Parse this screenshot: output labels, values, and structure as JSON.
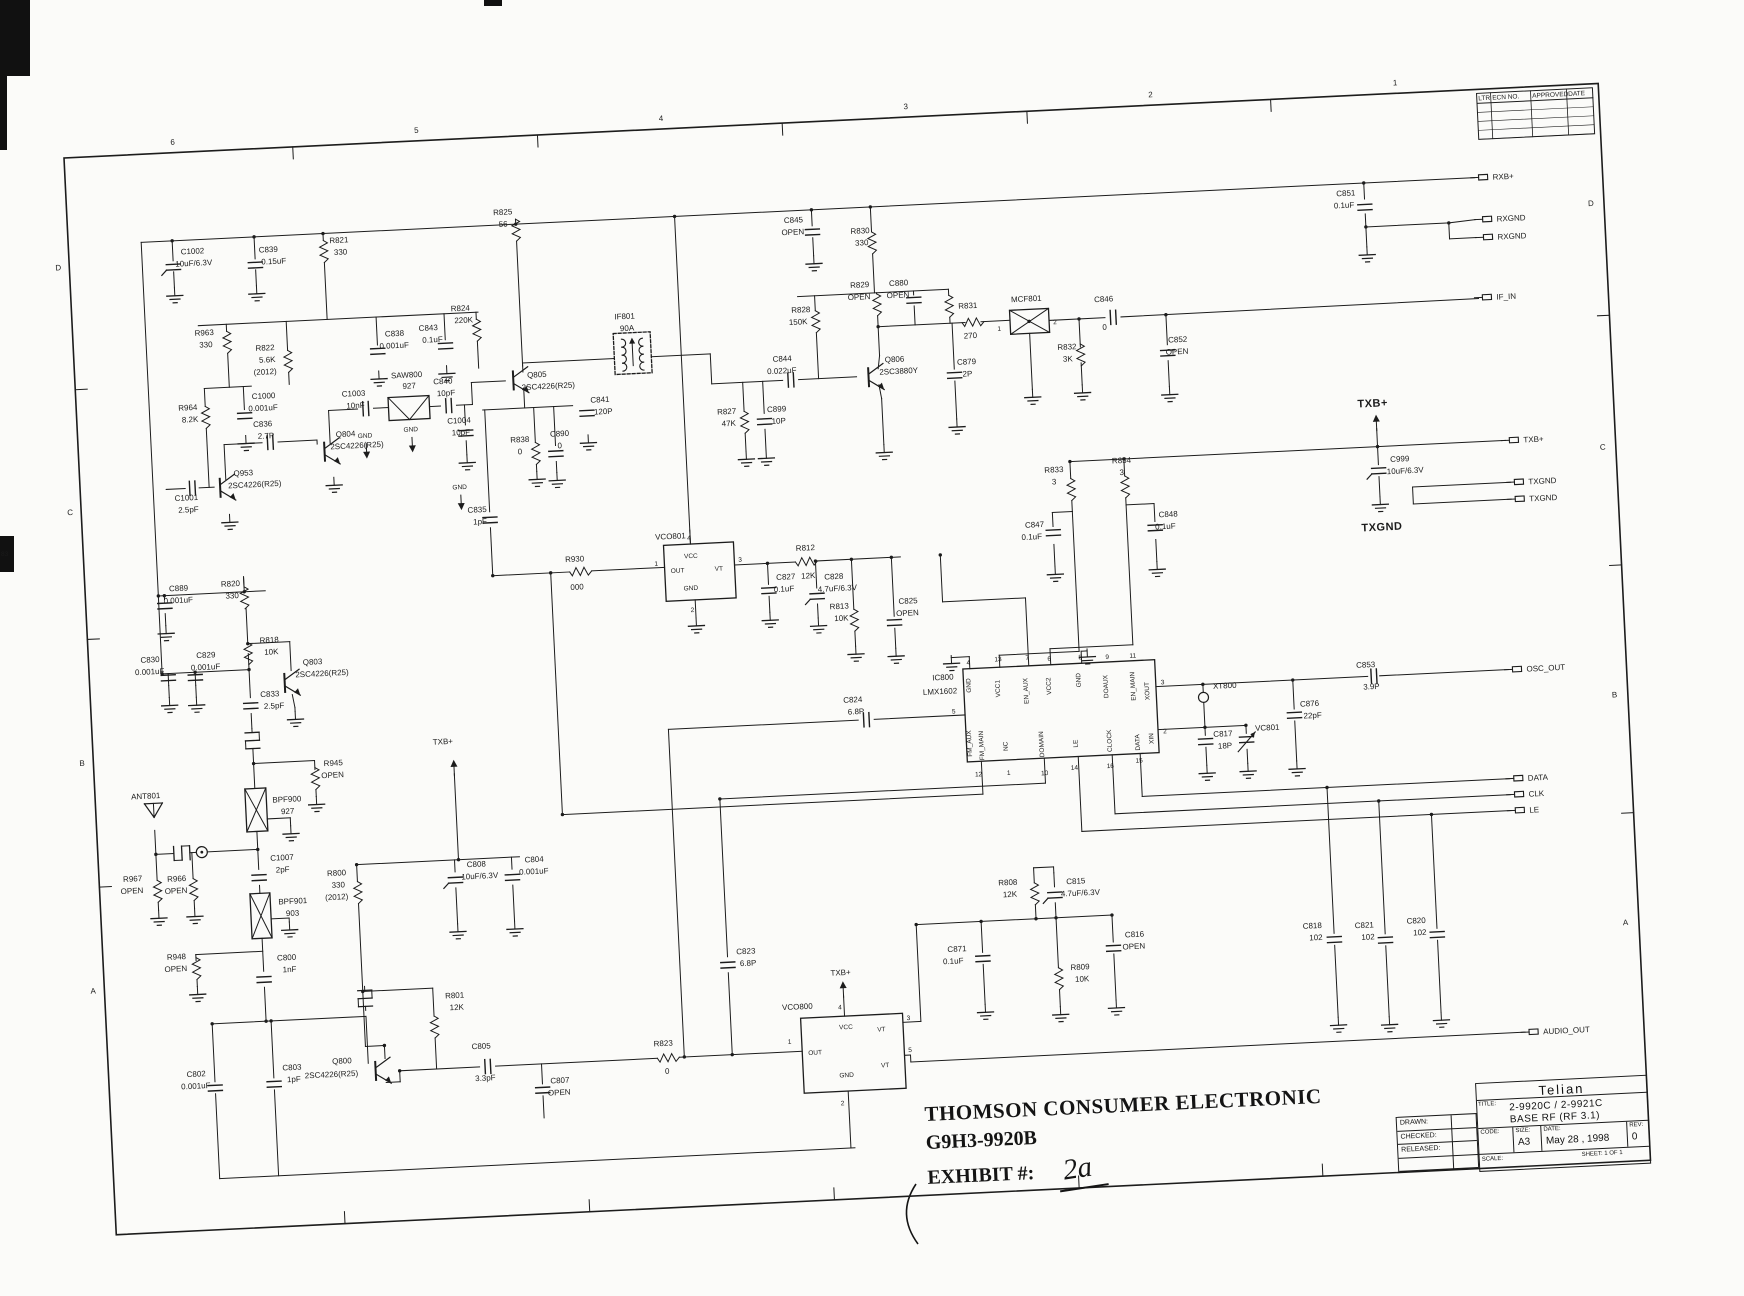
{
  "stamp": {
    "line1": "THOMSON CONSUMER ELECTRONIC",
    "line2": "G9H3-9920B",
    "exhibit_label": "EXHIBIT #:",
    "exhibit_value": "2a"
  },
  "title_block": {
    "company": "Telian",
    "title_label": "TITLE:",
    "title_line1": "2-9920C / 2-9921C",
    "title_line2": "BASE RF (RF 3.1)",
    "drawn_label": "DRAWN:",
    "checked_label": "CHECKED:",
    "released_label": "RELEASED:",
    "code_label": "CODE:",
    "size_label": "SIZE:",
    "size_value": "A3",
    "date_label": "DATE:",
    "date_value": "May 28 , 1998",
    "rev_label": "REV:",
    "rev_value": "0",
    "scale_label": "SCALE:",
    "sheet_label": "SHEET: 1  OF 1"
  },
  "grid": {
    "cols": [
      "6",
      "5",
      "4",
      "3",
      "2",
      "1"
    ],
    "col_x": [
      171,
      415,
      660,
      905,
      1150,
      1395
    ],
    "tick_x": [
      293,
      538,
      783,
      1028,
      1272
    ],
    "rows": [
      "D",
      "C",
      "B",
      "A"
    ],
    "row_y_left": [
      270,
      515,
      766,
      994
    ],
    "row_y_right": [
      280,
      524,
      772,
      1000
    ],
    "side_tick_y": [
      390,
      640,
      888
    ]
  },
  "revision_table": {
    "headers": [
      "LTR",
      "ECN NO.",
      "APPROVED",
      "DATE"
    ],
    "blank_rows": 4
  },
  "scan_marks": {
    "edge_tag": "83"
  },
  "terminals": [
    {
      "label": "RXB+",
      "x": 1476,
      "y": 246
    },
    {
      "label": "RXGND",
      "x": 1478,
      "y": 288
    },
    {
      "label": "RXGND",
      "x": 1478,
      "y": 306
    },
    {
      "label": "IF_IN",
      "x": 1474,
      "y": 366
    },
    {
      "label": "TXB+",
      "x": 1494,
      "y": 510
    },
    {
      "label": "TXGND",
      "x": 1497,
      "y": 552
    },
    {
      "label": "TXGND",
      "x": 1497,
      "y": 569
    },
    {
      "label": "OSC_OUT",
      "x": 1486,
      "y": 739
    },
    {
      "label": "DATA",
      "x": 1482,
      "y": 848
    },
    {
      "label": "CLK",
      "x": 1482,
      "y": 864
    },
    {
      "label": "LE",
      "x": 1482,
      "y": 880
    },
    {
      "label": "AUDIO_OUT",
      "x": 1485,
      "y": 1102
    }
  ],
  "ic_names": [
    {
      "t": "VCO801",
      "x": 636,
      "y": 568
    },
    {
      "t": "VCO800",
      "x": 740,
      "y": 1044
    },
    {
      "t": "IC800",
      "x": 906,
      "y": 722
    },
    {
      "t": "LMX1602",
      "x": 896,
      "y": 736
    },
    {
      "t": "MCF801",
      "x": 1003,
      "y": 348
    },
    {
      "t": "SAW800",
      "x": 380,
      "y": 394
    },
    {
      "t": "927",
      "x": 391,
      "y": 405
    },
    {
      "t": "IF801",
      "x": 606,
      "y": 346
    },
    {
      "t": "90A",
      "x": 611,
      "y": 358
    },
    {
      "t": "BPF900",
      "x": 241,
      "y": 812
    },
    {
      "t": "927",
      "x": 249,
      "y": 824
    },
    {
      "t": "BPF901",
      "x": 242,
      "y": 914
    },
    {
      "t": "903",
      "x": 249,
      "y": 926
    },
    {
      "t": "ANT801",
      "x": 100,
      "y": 802
    },
    {
      "t": "XT800",
      "x": 1186,
      "y": 744
    },
    {
      "t": "VC801",
      "x": 1226,
      "y": 788
    }
  ],
  "labels": [
    {
      "t": "C1002",
      "x": 176,
      "y": 260
    },
    {
      "t": "10uF/6.3V",
      "x": 170,
      "y": 272
    },
    {
      "t": "C839",
      "x": 254,
      "y": 262
    },
    {
      "t": "0.15uF",
      "x": 256,
      "y": 274
    },
    {
      "t": "R821",
      "x": 325,
      "y": 256
    },
    {
      "t": "330",
      "x": 329,
      "y": 268
    },
    {
      "t": "R825",
      "x": 490,
      "y": 236
    },
    {
      "t": "56",
      "x": 495,
      "y": 248
    },
    {
      "t": "R963",
      "x": 186,
      "y": 342
    },
    {
      "t": "330",
      "x": 190,
      "y": 354
    },
    {
      "t": "R822",
      "x": 246,
      "y": 360
    },
    {
      "t": "5.6K",
      "x": 249,
      "y": 372
    },
    {
      "t": "(2012)",
      "x": 243,
      "y": 384
    },
    {
      "t": "R964",
      "x": 166,
      "y": 416
    },
    {
      "t": "8.2K",
      "x": 169,
      "y": 428
    },
    {
      "t": "C1000",
      "x": 240,
      "y": 408
    },
    {
      "t": "0.001uF",
      "x": 236,
      "y": 420
    },
    {
      "t": "C838",
      "x": 376,
      "y": 352
    },
    {
      "t": "0.001uF",
      "x": 370,
      "y": 364
    },
    {
      "t": "C843",
      "x": 410,
      "y": 348
    },
    {
      "t": "0.1uF",
      "x": 413,
      "y": 360
    },
    {
      "t": "R824",
      "x": 443,
      "y": 330
    },
    {
      "t": "220K",
      "x": 446,
      "y": 342
    },
    {
      "t": "C1003",
      "x": 330,
      "y": 410
    },
    {
      "t": "10nF",
      "x": 334,
      "y": 422
    },
    {
      "t": "C840",
      "x": 422,
      "y": 402
    },
    {
      "t": "10pF",
      "x": 425,
      "y": 414
    },
    {
      "t": "C1004",
      "x": 434,
      "y": 442
    },
    {
      "t": "10pF",
      "x": 438,
      "y": 454
    },
    {
      "t": "Q953",
      "x": 218,
      "y": 484
    },
    {
      "t": "2SC4226(R25)",
      "x": 212,
      "y": 496
    },
    {
      "t": "C1001",
      "x": 158,
      "y": 506
    },
    {
      "t": "2.5pF",
      "x": 161,
      "y": 518
    },
    {
      "t": "C836",
      "x": 240,
      "y": 436
    },
    {
      "t": "2.7P",
      "x": 244,
      "y": 448
    },
    {
      "t": "Q804",
      "x": 322,
      "y": 450
    },
    {
      "t": "2SC4226(R25)",
      "x": 316,
      "y": 462
    },
    {
      "t": "GND",
      "x": 344,
      "y": 452,
      "c": "s"
    },
    {
      "t": "GND",
      "x": 390,
      "y": 448,
      "c": "s"
    },
    {
      "t": "GND",
      "x": 436,
      "y": 508,
      "c": "s"
    },
    {
      "t": "Q805",
      "x": 516,
      "y": 400
    },
    {
      "t": "2SC4226(R25)",
      "x": 510,
      "y": 412
    },
    {
      "t": "C841",
      "x": 578,
      "y": 428
    },
    {
      "t": "120P",
      "x": 581,
      "y": 440
    },
    {
      "t": "C835",
      "x": 450,
      "y": 532
    },
    {
      "t": "1pF",
      "x": 455,
      "y": 544
    },
    {
      "t": "R838",
      "x": 496,
      "y": 464
    },
    {
      "t": "0",
      "x": 503,
      "y": 476
    },
    {
      "t": "C890",
      "x": 536,
      "y": 460
    },
    {
      "t": "0",
      "x": 543,
      "y": 472
    },
    {
      "t": "R930",
      "x": 545,
      "y": 586
    },
    {
      "t": "000",
      "x": 549,
      "y": 614
    },
    {
      "t": "R812",
      "x": 776,
      "y": 586
    },
    {
      "t": "12K",
      "x": 780,
      "y": 614
    },
    {
      "t": "C827",
      "x": 755,
      "y": 614
    },
    {
      "t": "0.1uF",
      "x": 752,
      "y": 626
    },
    {
      "t": "C828",
      "x": 803,
      "y": 616
    },
    {
      "t": "4.7uF/6.3V",
      "x": 796,
      "y": 628
    },
    {
      "t": "R813",
      "x": 807,
      "y": 646
    },
    {
      "t": "10K",
      "x": 811,
      "y": 658
    },
    {
      "t": "C825",
      "x": 876,
      "y": 644
    },
    {
      "t": "OPEN",
      "x": 873,
      "y": 656
    },
    {
      "t": "C845",
      "x": 780,
      "y": 258
    },
    {
      "t": "OPEN",
      "x": 777,
      "y": 270
    },
    {
      "t": "R830",
      "x": 846,
      "y": 272
    },
    {
      "t": "330",
      "x": 850,
      "y": 284
    },
    {
      "t": "R828",
      "x": 783,
      "y": 348
    },
    {
      "t": "150K",
      "x": 780,
      "y": 360
    },
    {
      "t": "R829",
      "x": 843,
      "y": 326
    },
    {
      "t": "OPEN",
      "x": 840,
      "y": 338
    },
    {
      "t": "C880",
      "x": 882,
      "y": 326
    },
    {
      "t": "OPEN",
      "x": 879,
      "y": 338
    },
    {
      "t": "R831",
      "x": 950,
      "y": 352
    },
    {
      "t": "270",
      "x": 954,
      "y": 382
    },
    {
      "t": "R832",
      "x": 1047,
      "y": 398
    },
    {
      "t": "3K",
      "x": 1052,
      "y": 410
    },
    {
      "t": "C846",
      "x": 1086,
      "y": 352
    },
    {
      "t": "0",
      "x": 1093,
      "y": 380
    },
    {
      "t": "C852",
      "x": 1158,
      "y": 396
    },
    {
      "t": "OPEN",
      "x": 1155,
      "y": 408
    },
    {
      "t": "C844",
      "x": 762,
      "y": 396
    },
    {
      "t": "0.022uF",
      "x": 756,
      "y": 408
    },
    {
      "t": "R827",
      "x": 704,
      "y": 446
    },
    {
      "t": "47K",
      "x": 708,
      "y": 458
    },
    {
      "t": "C899",
      "x": 754,
      "y": 446
    },
    {
      "t": "10P",
      "x": 758,
      "y": 458
    },
    {
      "t": "Q806",
      "x": 874,
      "y": 402
    },
    {
      "t": "2SC3880Y",
      "x": 868,
      "y": 414
    },
    {
      "t": "C879",
      "x": 946,
      "y": 408
    },
    {
      "t": "2P",
      "x": 951,
      "y": 420
    },
    {
      "t": "C851",
      "x": 1333,
      "y": 258
    },
    {
      "t": "0.1uF",
      "x": 1330,
      "y": 270
    },
    {
      "t": "R833",
      "x": 1028,
      "y": 520
    },
    {
      "t": "3",
      "x": 1035,
      "y": 532
    },
    {
      "t": "R834",
      "x": 1096,
      "y": 514
    },
    {
      "t": "3",
      "x": 1103,
      "y": 526
    },
    {
      "t": "C847",
      "x": 1006,
      "y": 574
    },
    {
      "t": "0.1uF",
      "x": 1002,
      "y": 586
    },
    {
      "t": "C848",
      "x": 1140,
      "y": 570
    },
    {
      "t": "0.1uF",
      "x": 1136,
      "y": 582
    },
    {
      "t": "TXB+",
      "x": 1344,
      "y": 470,
      "c": "l"
    },
    {
      "t": "C999",
      "x": 1374,
      "y": 526
    },
    {
      "t": "10uF/6.3V",
      "x": 1370,
      "y": 538
    },
    {
      "t": "TXGND",
      "x": 1342,
      "y": 594,
      "c": "l"
    },
    {
      "t": "C817",
      "x": 1184,
      "y": 792
    },
    {
      "t": "18P",
      "x": 1188,
      "y": 804
    },
    {
      "t": "C876",
      "x": 1272,
      "y": 766
    },
    {
      "t": "22pF",
      "x": 1275,
      "y": 778
    },
    {
      "t": "C853",
      "x": 1330,
      "y": 730
    },
    {
      "t": "3.9P",
      "x": 1336,
      "y": 752
    },
    {
      "t": "C824",
      "x": 816,
      "y": 740
    },
    {
      "t": "6.8P",
      "x": 820,
      "y": 752
    },
    {
      "t": "C889",
      "x": 148,
      "y": 596
    },
    {
      "t": "0.001uF",
      "x": 142,
      "y": 608
    },
    {
      "t": "R820",
      "x": 200,
      "y": 594
    },
    {
      "t": "330",
      "x": 204,
      "y": 606
    },
    {
      "t": "R818",
      "x": 236,
      "y": 652
    },
    {
      "t": "10K",
      "x": 240,
      "y": 664
    },
    {
      "t": "C830",
      "x": 116,
      "y": 666
    },
    {
      "t": "0.001uF",
      "x": 110,
      "y": 678
    },
    {
      "t": "C829",
      "x": 172,
      "y": 664
    },
    {
      "t": "0.001uF",
      "x": 166,
      "y": 676
    },
    {
      "t": "Q803",
      "x": 278,
      "y": 676
    },
    {
      "t": "2SC4226(R25)",
      "x": 270,
      "y": 688
    },
    {
      "t": "C833",
      "x": 234,
      "y": 706
    },
    {
      "t": "2.5pF",
      "x": 237,
      "y": 718
    },
    {
      "t": "R945",
      "x": 294,
      "y": 778
    },
    {
      "t": "OPEN",
      "x": 291,
      "y": 790
    },
    {
      "t": "R967",
      "x": 88,
      "y": 884
    },
    {
      "t": "OPEN",
      "x": 85,
      "y": 896
    },
    {
      "t": "R966",
      "x": 132,
      "y": 886
    },
    {
      "t": "OPEN",
      "x": 129,
      "y": 898
    },
    {
      "t": "C1007",
      "x": 236,
      "y": 870
    },
    {
      "t": "2pF",
      "x": 241,
      "y": 882
    },
    {
      "t": "R948",
      "x": 128,
      "y": 964
    },
    {
      "t": "OPEN",
      "x": 125,
      "y": 976
    },
    {
      "t": "C800",
      "x": 238,
      "y": 970
    },
    {
      "t": "1nF",
      "x": 243,
      "y": 982
    },
    {
      "t": "R800",
      "x": 292,
      "y": 888
    },
    {
      "t": "330",
      "x": 296,
      "y": 900
    },
    {
      "t": "(2012)",
      "x": 289,
      "y": 912
    },
    {
      "t": "TXB+",
      "x": 404,
      "y": 762
    },
    {
      "t": "C808",
      "x": 432,
      "y": 886
    },
    {
      "t": "10uF/6.3V",
      "x": 426,
      "y": 898
    },
    {
      "t": "C804",
      "x": 490,
      "y": 884
    },
    {
      "t": "0.001uF",
      "x": 484,
      "y": 896
    },
    {
      "t": "R801",
      "x": 404,
      "y": 1016
    },
    {
      "t": "12K",
      "x": 408,
      "y": 1028
    },
    {
      "t": "Q800",
      "x": 288,
      "y": 1076
    },
    {
      "t": "2SC4226(R25)",
      "x": 260,
      "y": 1089
    },
    {
      "t": "C802",
      "x": 142,
      "y": 1082
    },
    {
      "t": "0.001uF",
      "x": 136,
      "y": 1094
    },
    {
      "t": "C803",
      "x": 238,
      "y": 1080
    },
    {
      "t": "1pF",
      "x": 242,
      "y": 1092
    },
    {
      "t": "C805",
      "x": 428,
      "y": 1068
    },
    {
      "t": "3.3pF",
      "x": 430,
      "y": 1100
    },
    {
      "t": "C807",
      "x": 505,
      "y": 1106
    },
    {
      "t": "OPEN",
      "x": 502,
      "y": 1118
    },
    {
      "t": "R823",
      "x": 610,
      "y": 1074
    },
    {
      "t": "0",
      "x": 620,
      "y": 1102
    },
    {
      "t": "C823",
      "x": 697,
      "y": 986
    },
    {
      "t": "6.8P",
      "x": 700,
      "y": 998
    },
    {
      "t": "TXB+",
      "x": 790,
      "y": 1012
    },
    {
      "t": "R808",
      "x": 962,
      "y": 930
    },
    {
      "t": "12K",
      "x": 966,
      "y": 942
    },
    {
      "t": "C871",
      "x": 908,
      "y": 994
    },
    {
      "t": "0.1uF",
      "x": 903,
      "y": 1006
    },
    {
      "t": "C815",
      "x": 1030,
      "y": 932
    },
    {
      "t": "4.7uF/6.3V",
      "x": 1024,
      "y": 944
    },
    {
      "t": "R809",
      "x": 1030,
      "y": 1018
    },
    {
      "t": "10K",
      "x": 1034,
      "y": 1030
    },
    {
      "t": "C816",
      "x": 1086,
      "y": 988
    },
    {
      "t": "OPEN",
      "x": 1083,
      "y": 1000
    },
    {
      "t": "C818",
      "x": 1264,
      "y": 988
    },
    {
      "t": "102",
      "x": 1270,
      "y": 1000
    },
    {
      "t": "C821",
      "x": 1316,
      "y": 990
    },
    {
      "t": "102",
      "x": 1322,
      "y": 1002
    },
    {
      "t": "C820",
      "x": 1368,
      "y": 988
    },
    {
      "t": "102",
      "x": 1374,
      "y": 1000
    },
    {
      "t": "4",
      "x": 941,
      "y": 708,
      "c": "s"
    },
    {
      "t": "13",
      "x": 969,
      "y": 706,
      "c": "s"
    },
    {
      "t": "7",
      "x": 1000,
      "y": 706,
      "c": "s"
    },
    {
      "t": "6",
      "x": 1022,
      "y": 708,
      "c": "s"
    },
    {
      "t": "8",
      "x": 1053,
      "y": 708,
      "c": "s"
    },
    {
      "t": "9",
      "x": 1080,
      "y": 709,
      "c": "s"
    },
    {
      "t": "11",
      "x": 1104,
      "y": 709,
      "c": "s"
    },
    {
      "t": "3",
      "x": 1134,
      "y": 737,
      "c": "s"
    },
    {
      "t": "2",
      "x": 1134,
      "y": 786,
      "c": "s"
    },
    {
      "t": "5",
      "x": 924,
      "y": 756,
      "c": "s"
    },
    {
      "t": "12",
      "x": 944,
      "y": 820,
      "c": "s"
    },
    {
      "t": "1",
      "x": 976,
      "y": 820,
      "c": "s"
    },
    {
      "t": "10",
      "x": 1010,
      "y": 822,
      "c": "s"
    },
    {
      "t": "14",
      "x": 1040,
      "y": 818,
      "c": "s"
    },
    {
      "t": "16",
      "x": 1076,
      "y": 818,
      "c": "s"
    },
    {
      "t": "15",
      "x": 1105,
      "y": 814,
      "c": "s"
    },
    {
      "t": "GND",
      "x": 944,
      "y": 736,
      "c": "v"
    },
    {
      "t": "VCC1",
      "x": 973,
      "y": 742,
      "c": "v"
    },
    {
      "t": "EN_AUX",
      "x": 1001,
      "y": 750,
      "c": "v"
    },
    {
      "t": "VCC2",
      "x": 1024,
      "y": 742,
      "c": "v"
    },
    {
      "t": "GND",
      "x": 1054,
      "y": 736,
      "c": "v"
    },
    {
      "t": "DOAUX",
      "x": 1081,
      "y": 748,
      "c": "v"
    },
    {
      "t": "EN_MAIN",
      "x": 1108,
      "y": 752,
      "c": "v"
    },
    {
      "t": "XOUT",
      "x": 1122,
      "y": 752,
      "c": "v"
    },
    {
      "t": "XIN",
      "x": 1124,
      "y": 796,
      "c": "v"
    },
    {
      "t": "FM_AUX",
      "x": 942,
      "y": 800,
      "c": "v"
    },
    {
      "t": "FM_MAIN",
      "x": 954,
      "y": 804,
      "c": "v"
    },
    {
      "t": "NC",
      "x": 978,
      "y": 796,
      "c": "v"
    },
    {
      "t": "DOMAIN",
      "x": 1014,
      "y": 804,
      "c": "v"
    },
    {
      "t": "LE",
      "x": 1048,
      "y": 796,
      "c": "v"
    },
    {
      "t": "CLOCK",
      "x": 1082,
      "y": 802,
      "c": "v"
    },
    {
      "t": "DATA",
      "x": 1110,
      "y": 802,
      "c": "v"
    },
    {
      "t": "4",
      "x": 668,
      "y": 570,
      "c": "s"
    },
    {
      "t": "VCC",
      "x": 664,
      "y": 588,
      "c": "s"
    },
    {
      "t": "1",
      "x": 634,
      "y": 594,
      "c": "s"
    },
    {
      "t": "OUT",
      "x": 650,
      "y": 602,
      "c": "s"
    },
    {
      "t": "VT",
      "x": 694,
      "y": 602,
      "c": "s"
    },
    {
      "t": "3",
      "x": 718,
      "y": 594,
      "c": "s"
    },
    {
      "t": "GND",
      "x": 662,
      "y": 620,
      "c": "s"
    },
    {
      "t": "2",
      "x": 668,
      "y": 642,
      "c": "s"
    },
    {
      "t": "4",
      "x": 796,
      "y": 1046,
      "c": "s"
    },
    {
      "t": "VCC",
      "x": 796,
      "y": 1066,
      "c": "s"
    },
    {
      "t": "1",
      "x": 744,
      "y": 1078,
      "c": "s"
    },
    {
      "t": "OUT",
      "x": 764,
      "y": 1090,
      "c": "s"
    },
    {
      "t": "3",
      "x": 864,
      "y": 1060,
      "c": "s"
    },
    {
      "t": "VT",
      "x": 834,
      "y": 1070,
      "c": "s"
    },
    {
      "t": "5",
      "x": 864,
      "y": 1092,
      "c": "s"
    },
    {
      "t": "VT",
      "x": 836,
      "y": 1106,
      "c": "s"
    },
    {
      "t": "GND",
      "x": 794,
      "y": 1114,
      "c": "s"
    },
    {
      "t": "2",
      "x": 794,
      "y": 1142,
      "c": "s"
    },
    {
      "t": "1",
      "x": 988,
      "y": 376,
      "c": "s"
    },
    {
      "t": "2",
      "x": 1044,
      "y": 372,
      "c": "s"
    }
  ]
}
